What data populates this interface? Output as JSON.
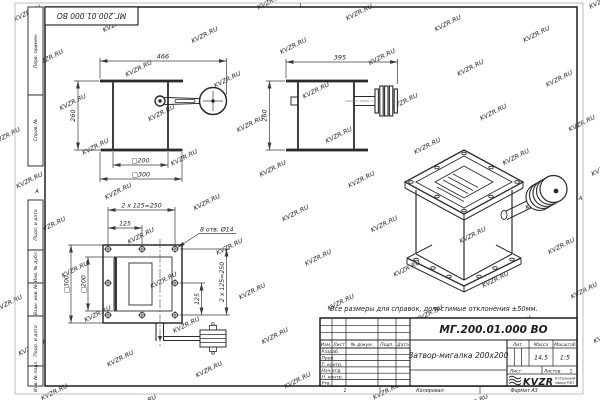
{
  "watermark": {
    "text": "KVZR.RU"
  },
  "frame": {
    "top_designation": "МГ.200.01.000 ВО",
    "zone_left": "А",
    "zone_right": "А",
    "left_labels": [
      "Перв. примен.",
      "Справ. №",
      "Подп. и дата",
      "Инв. № дубл.",
      "Взам. инв. №",
      "Подп. и дата",
      "Инв. № подл."
    ]
  },
  "note": "Все размеры для справок, допустимые отклонения ±50мм.",
  "views": {
    "front": {
      "dim_width": "466",
      "dim_height": "260",
      "dim_inner": "□200",
      "dim_outer": "□300"
    },
    "side": {
      "dim_width": "395",
      "dim_height": "260"
    },
    "plan": {
      "dim_pitch_top": "2 x 125=250",
      "dim_125_top": "125",
      "dim_holes": "8 отв. Ø14",
      "dim_outer": "□300",
      "dim_inner": "□200",
      "dim_pitch_right": "2 x 125=250",
      "dim_125_right": "125"
    }
  },
  "title_block": {
    "designation": "МГ.200.01.000 ВО",
    "name": "Затвор-мигалка 200x200",
    "cols": {
      "izm": "Изм.",
      "list": "Лист",
      "doc": "№ докум.",
      "sign": "Подп.",
      "date": "Дата"
    },
    "rows": [
      "Разраб.",
      "Пров.",
      "Т. контр.",
      "Нач.отд.",
      "Н. контр.",
      "Утв."
    ],
    "lit_label": "Лит.",
    "mass_label": "Масса",
    "scale_label": "Масштаб",
    "mass_value": "14,5",
    "scale_value": "1:5",
    "sheet_label": "Лист",
    "sheets_label": "Листов",
    "sheets_value": "1",
    "logo_text": "KVZR",
    "org_line1": "Котельный",
    "org_line2": "завод РЭП"
  },
  "footer": {
    "zone": "1",
    "copied": "Копировал",
    "format": "Формат А3"
  }
}
